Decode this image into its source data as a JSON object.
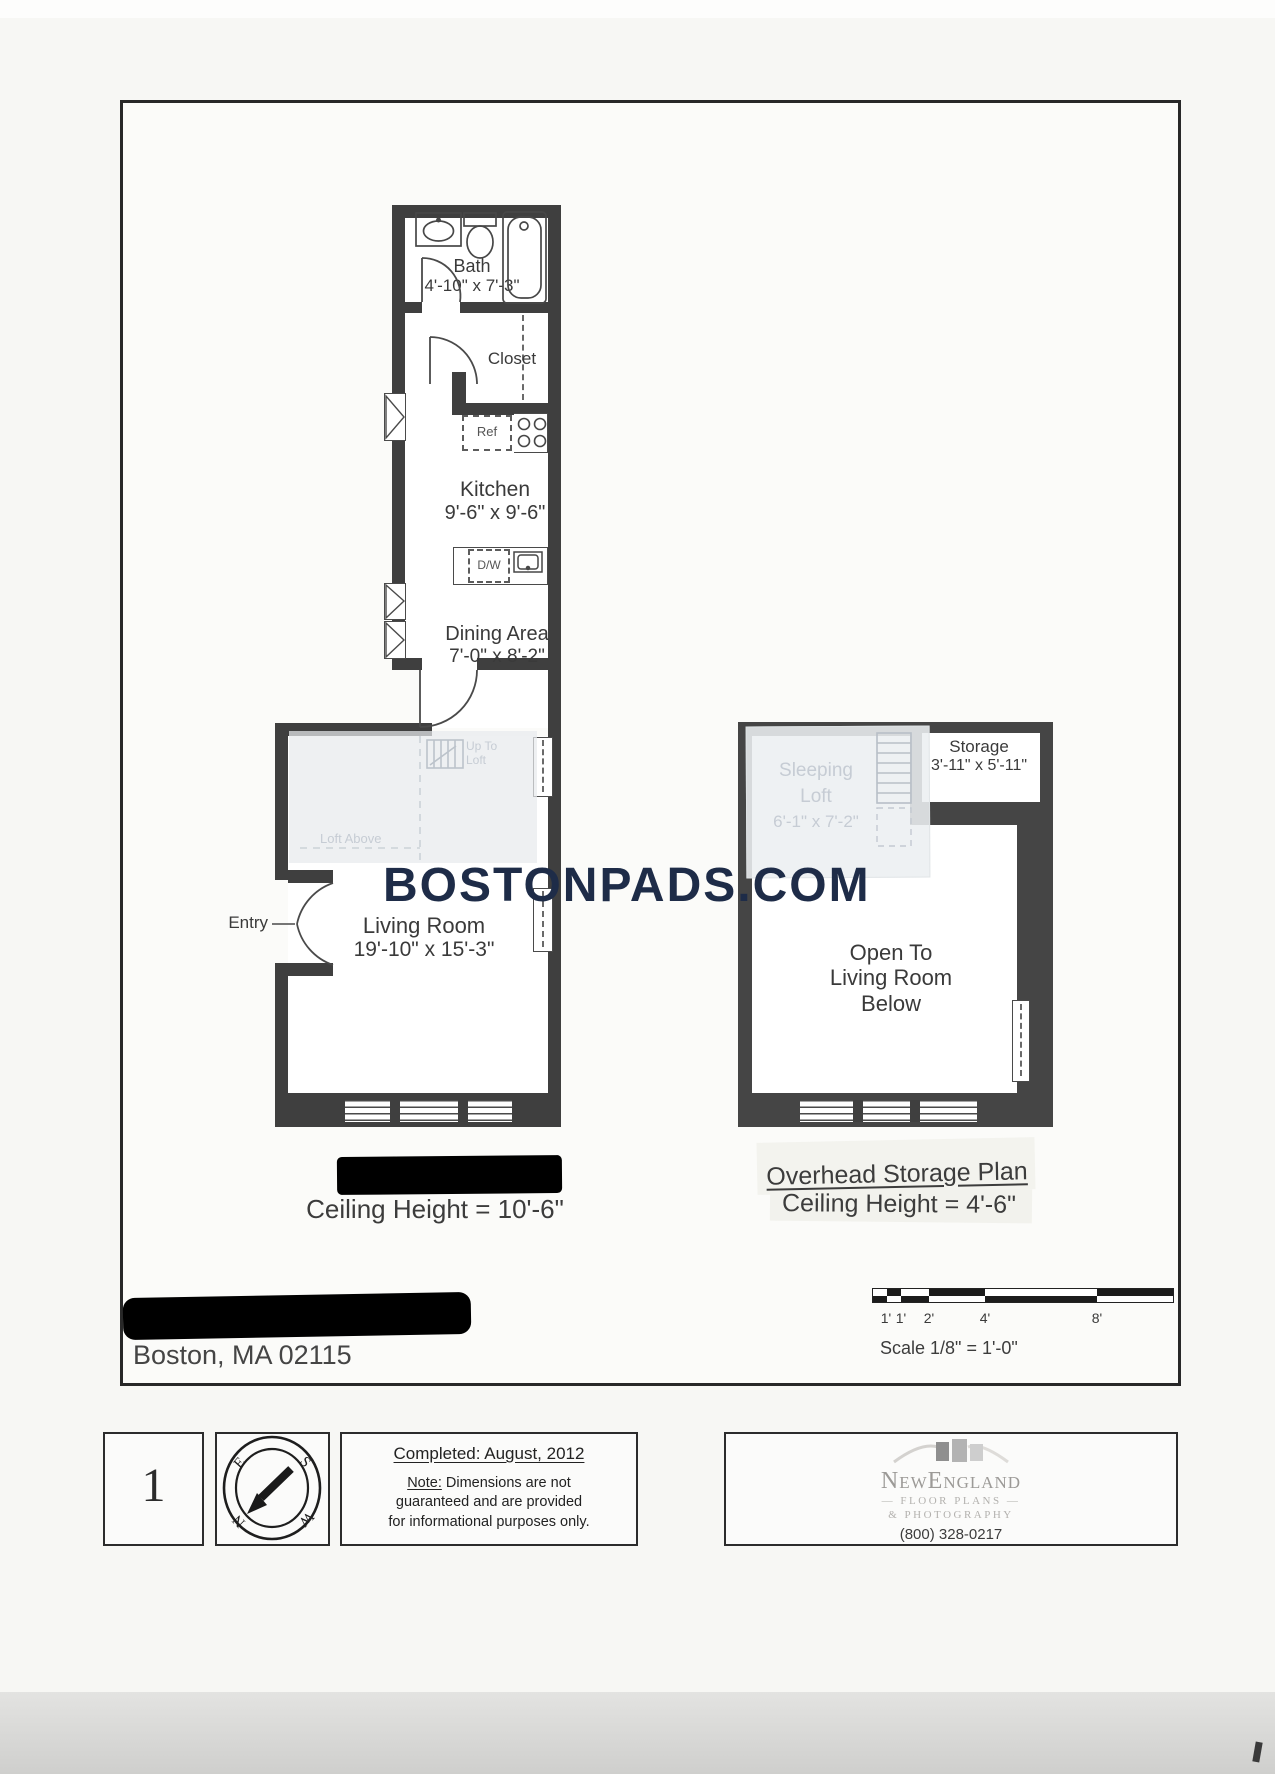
{
  "colors": {
    "wall": "#3f3f3f",
    "watermark": "#1e2c48",
    "redaction": "#000000",
    "paper": "#f7f7f4"
  },
  "watermark": {
    "text": "BOSTONPADS.COM"
  },
  "main_plan": {
    "bath": {
      "name": "Bath",
      "dims": "4'-10\" x 7'-3\""
    },
    "closet": {
      "name": "Closet"
    },
    "kitchen": {
      "name": "Kitchen",
      "dims": "9'-6\" x 9'-6\""
    },
    "dining": {
      "name": "Dining Area",
      "dims": "7'-0\" x 8'-2\""
    },
    "living": {
      "name": "Living Room",
      "dims": "19'-10\" x 15'-3\""
    },
    "entry_label": "Entry",
    "ref_label": "Ref",
    "dw_label": "D/W",
    "up_to_loft_1": "Up To",
    "up_to_loft_2": "Loft",
    "loft_above": "Loft Above",
    "ceiling": "Ceiling Height = 10'-6\""
  },
  "loft_plan": {
    "sleeping_1": "Sleeping",
    "sleeping_2": "Loft",
    "sleeping_dims": "6'-1\" x 7'-2\"",
    "storage": {
      "name": "Storage",
      "dims": "3'-11\" x 5'-11\""
    },
    "open_1": "Open To",
    "open_2": "Living Room",
    "open_3": "Below",
    "title": "Overhead Storage Plan",
    "ceiling": "Ceiling Height = 4'-6\""
  },
  "address": {
    "line": "Boston, MA 02115"
  },
  "scale": {
    "text": "Scale  1/8\" = 1'-0\"",
    "ticks": [
      "1'",
      "1'",
      "2'",
      "4'",
      "8'"
    ]
  },
  "footer": {
    "page": "1",
    "compass": {
      "e": "E",
      "s": "S",
      "n": "N",
      "w": "W"
    },
    "completed": "Completed: August, 2012",
    "note_label": "Note:",
    "note_1": " Dimensions are not",
    "note_2": "guaranteed and are provided",
    "note_3": "for informational purposes only.",
    "logo": {
      "name": "NewEngland",
      "line2": "— FLOOR PLANS —",
      "line3": "& PHOTOGRAPHY",
      "phone": "(800) 328-0217"
    }
  }
}
